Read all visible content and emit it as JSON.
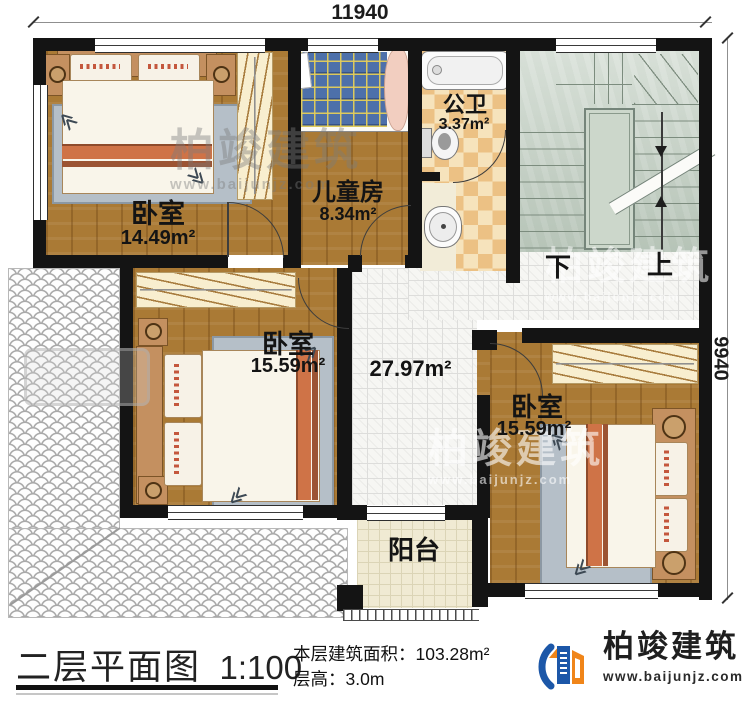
{
  "dimensions": {
    "width": "11940",
    "height": "9940"
  },
  "rooms": {
    "bedroom1": {
      "label": "卧室",
      "area": "14.49m²"
    },
    "kids_room": {
      "label": "儿童房",
      "area": "8.34m²"
    },
    "bathroom": {
      "label": "公卫",
      "area": "3.37m²"
    },
    "bedroom2": {
      "label": "卧室",
      "area": "15.59m²"
    },
    "hall": {
      "area": "27.97m²"
    },
    "bedroom3": {
      "label": "卧室",
      "area": "15.59m²"
    },
    "balcony": {
      "label": "阳台"
    }
  },
  "stairs": {
    "down_label": "下",
    "up_label": "上"
  },
  "title_block": {
    "title": "二层平面图",
    "scale": "1:100",
    "building_area_label": "本层建筑面积：",
    "building_area_value": "103.28m²",
    "floor_height_label": "层高：",
    "floor_height_value": "3.0m"
  },
  "brand": {
    "name": "柏竣建筑",
    "website": "www.baijunjz.com"
  },
  "watermark": {
    "name": "柏竣建筑",
    "website": "www.baijunjz.com"
  },
  "colors": {
    "wall": "#141414",
    "wood": "#aa7a35",
    "stair": "#c6d2c6",
    "brand_blue": "#1c57a8",
    "brand_orange": "#f08519"
  }
}
